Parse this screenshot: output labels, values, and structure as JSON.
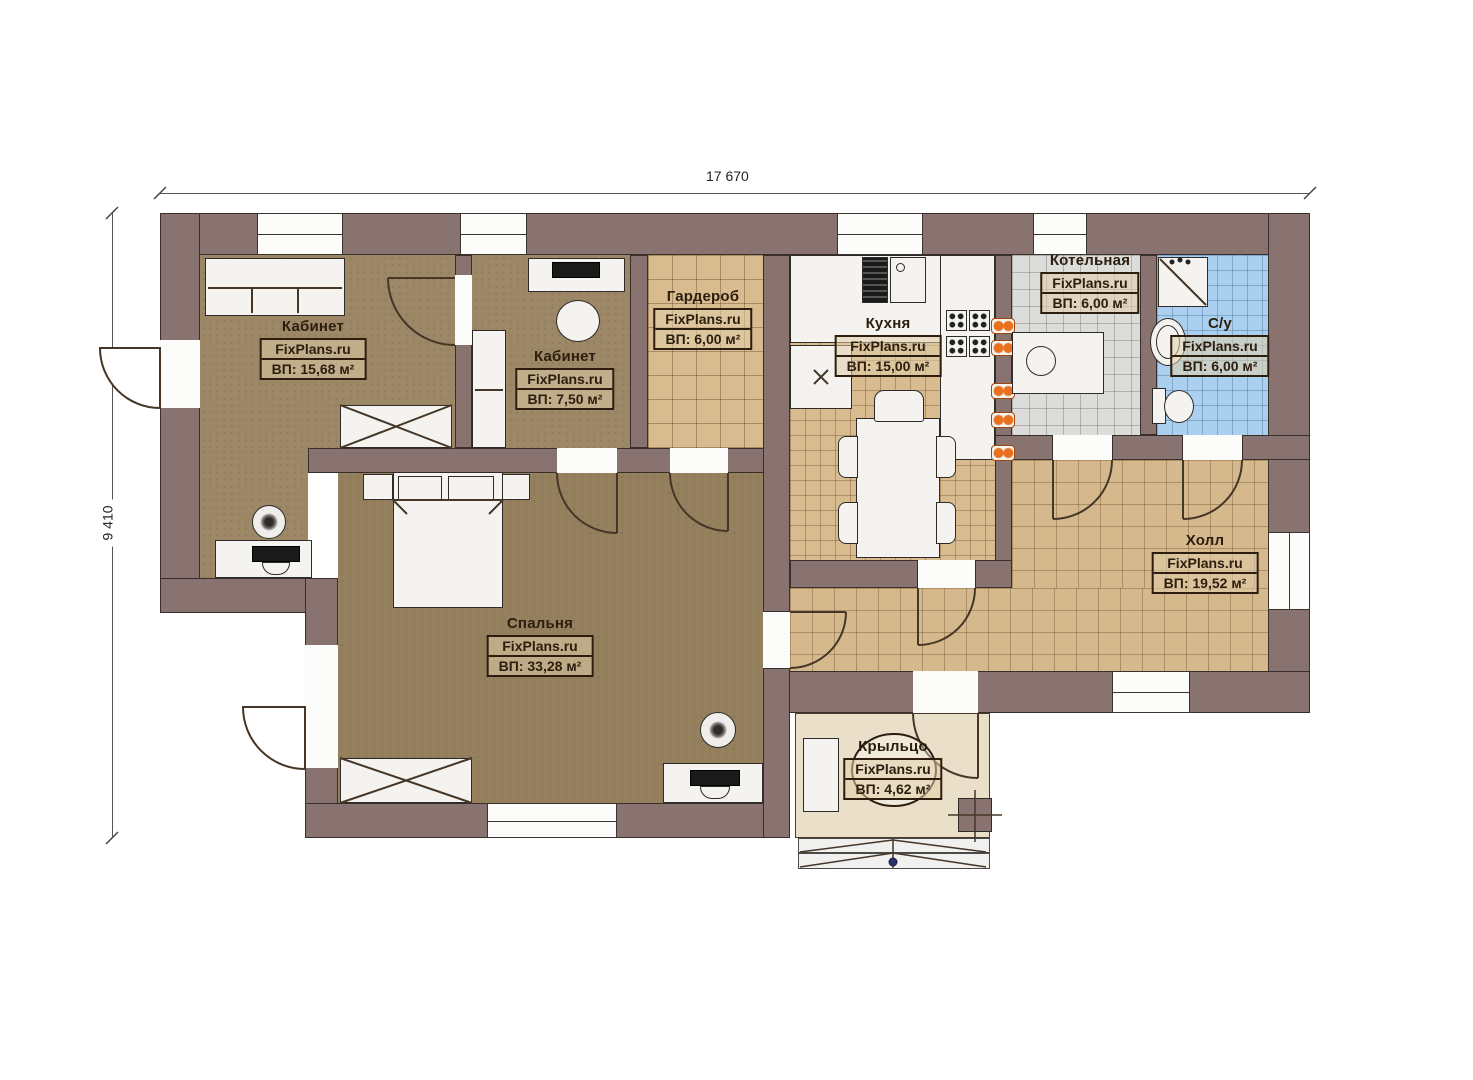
{
  "watermark": "FixPlans.ru",
  "dimensions": {
    "width_label": "17 670",
    "height_label": "9 410"
  },
  "rooms": [
    {
      "id": "office1",
      "name": "Кабинет",
      "watermark": "FixPlans.ru",
      "area": "ВП: 15,68 м²"
    },
    {
      "id": "office2",
      "name": "Кабинет",
      "watermark": "FixPlans.ru",
      "area": "ВП: 7,50 м²"
    },
    {
      "id": "wardrobe",
      "name": "Гардероб",
      "watermark": "FixPlans.ru",
      "area": "ВП: 6,00 м²"
    },
    {
      "id": "kitchen",
      "name": "Кухня",
      "watermark": "FixPlans.ru",
      "area": "ВП: 15,00 м²"
    },
    {
      "id": "boiler",
      "name": "Котельная",
      "watermark": "FixPlans.ru",
      "area": "ВП: 6,00 м²"
    },
    {
      "id": "bathroom",
      "name": "С/у",
      "watermark": "FixPlans.ru",
      "area": "ВП: 6,00 м²"
    },
    {
      "id": "hall",
      "name": "Холл",
      "watermark": "FixPlans.ru",
      "area": "ВП: 19,52 м²"
    },
    {
      "id": "bedroom",
      "name": "Спальня",
      "watermark": "FixPlans.ru",
      "area": "ВП: 33,28 м²"
    },
    {
      "id": "porch",
      "name": "Крыльцо",
      "watermark": "FixPlans.ru",
      "area": "ВП: 4,62 м²"
    }
  ],
  "colors": {
    "wall": "#897370",
    "office_floor": "#9c8767",
    "bedroom_floor": "#95805e",
    "tile_tan": "#d8bc90",
    "tile_gray": "#dcdcda",
    "tile_blue": "#abcfee",
    "porch_floor": "#eadfc8",
    "accent_orange": "#e8701e",
    "label_ink": "#2c1d0e"
  }
}
